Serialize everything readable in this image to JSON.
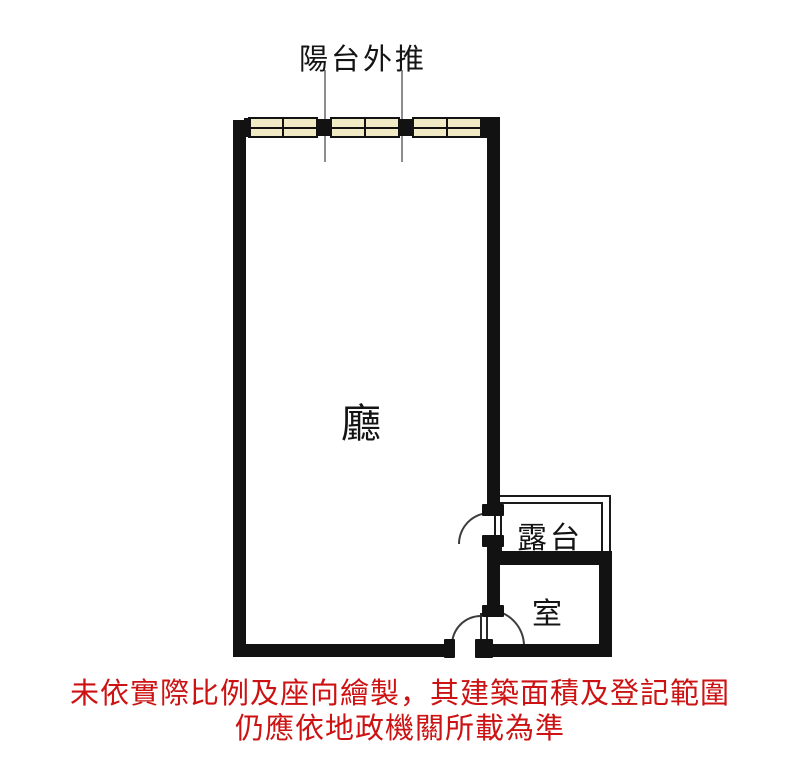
{
  "floorplan": {
    "annotation_top": "陽台外推",
    "rooms": {
      "living": "廳",
      "terrace": "露台",
      "bedroom": "室"
    },
    "disclaimer": {
      "line1": "未依實際比例及座向繪製，其建築面積及登記範圍",
      "line2": "仍應依地政機關所載為準"
    },
    "colors": {
      "wall": "#121212",
      "window_fill": "#f2e9c5",
      "window_border": "#121212",
      "leader_line": "#8d8d8d",
      "door_arc": "#3c3c3c",
      "disclaimer_text": "#cc1212",
      "background": "#ffffff"
    }
  }
}
